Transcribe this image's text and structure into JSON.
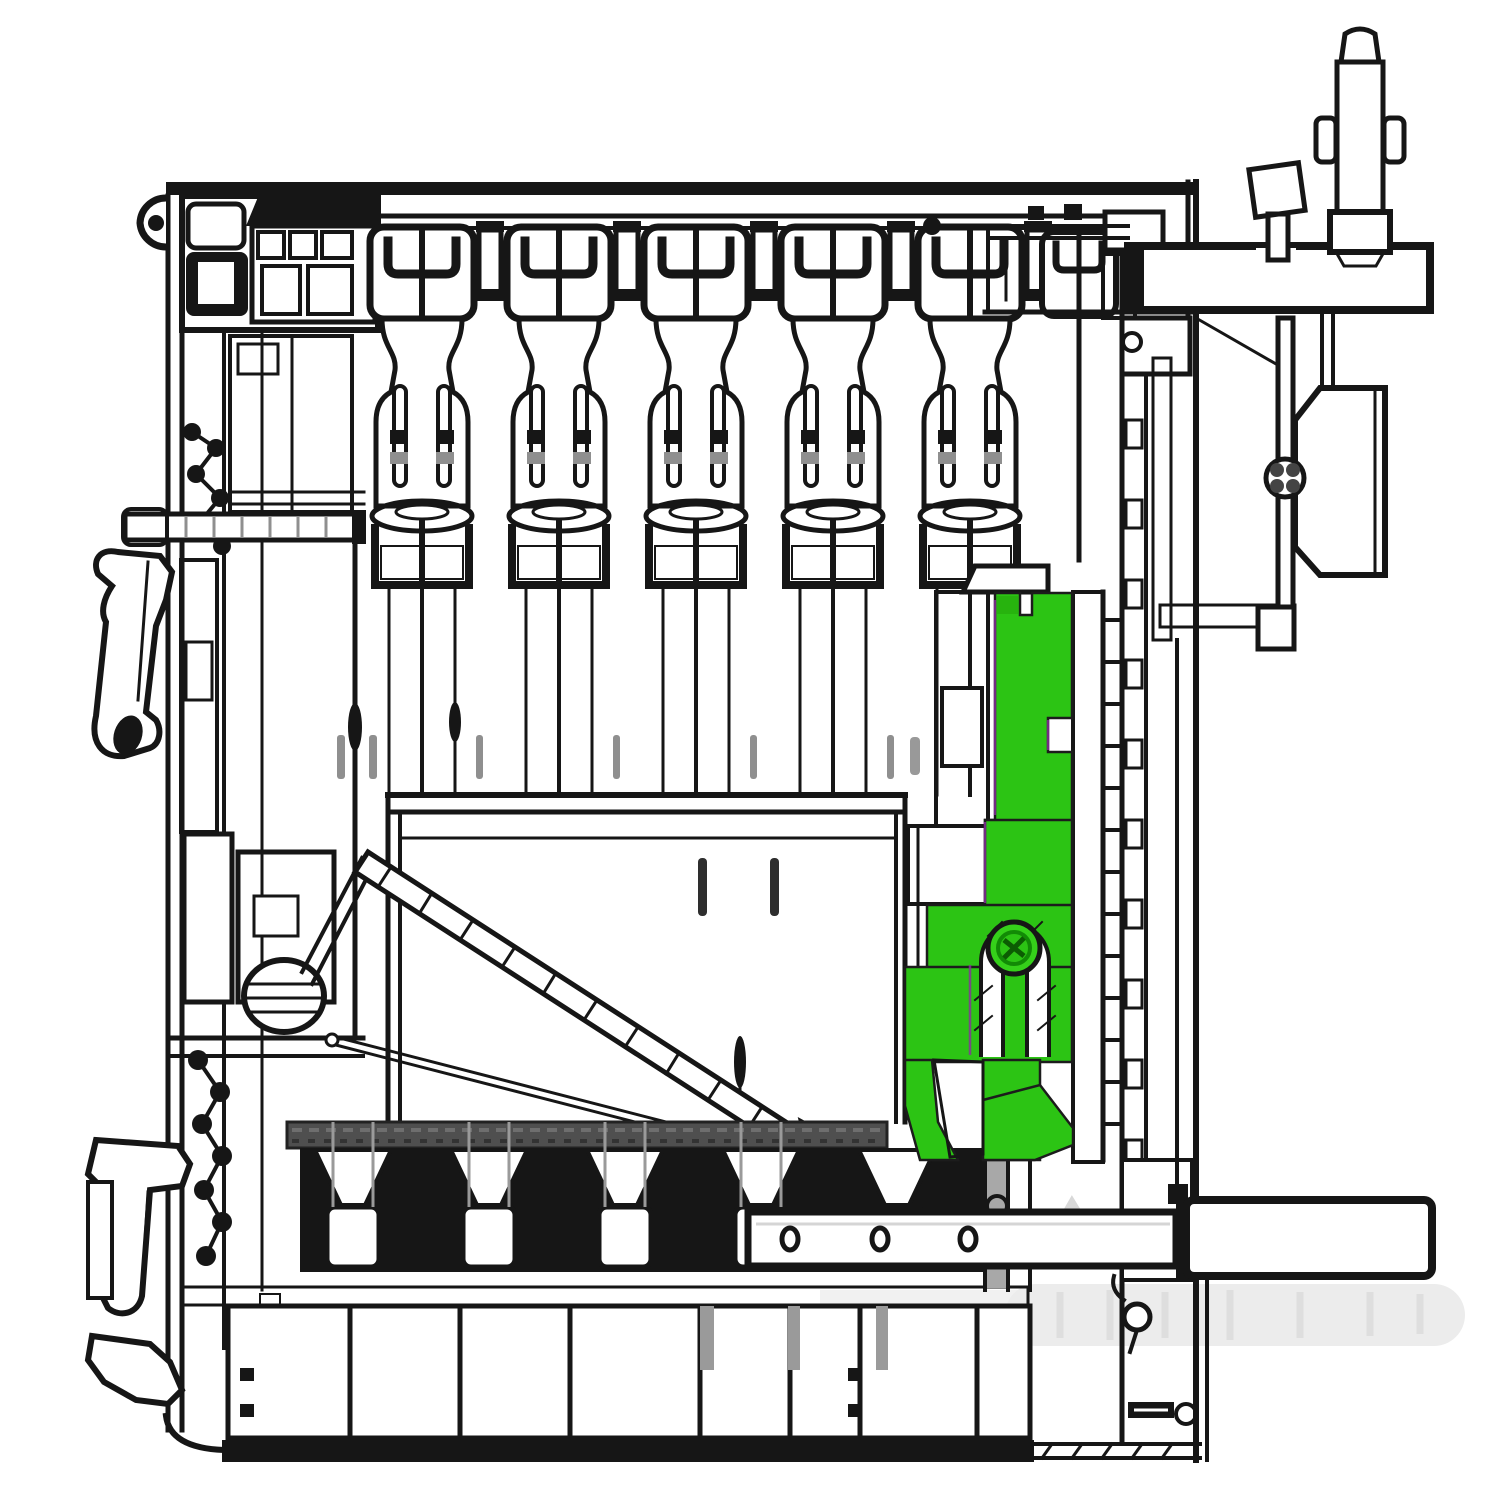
{
  "page": {
    "background": "#ffffff",
    "width": 1500,
    "height": 1500
  },
  "palette": {
    "ink": "#161616",
    "mid_gray": "#8f8f8f",
    "soft_gray": "#c7c7c7",
    "dark_band_gray": "#4f4f4f",
    "ghost_gray": "#ececec",
    "highlight_green": "#2cc414",
    "highlight_green_dark": "#128a06",
    "accent_magenta": "#8a2f9e"
  },
  "diagram": {
    "kind": "black-and-white machine cross-section drawing with one component highlighted in green",
    "highlight": {
      "label": "highlighted bracket with arch slot and pivot screw",
      "color": "#2cc414"
    },
    "counts": {
      "top_plunger_units": 6,
      "bottom_segment_cells": 5,
      "holes_in_bottom_bar": 3,
      "left_side_clamps": 3
    },
    "labels": {
      "frame": "machine frame cross-section",
      "top_rail": "top frame rail",
      "plunger_array": "vertical plunger unit array",
      "left_column": "left-side linkage column",
      "left_clamps": "left mounting clamps",
      "open_room": "open interior chamber",
      "diagonal_lever": "hatched diagonal lever",
      "highlighted_part": "highlighted bracket (green)",
      "pivot_screw": "green pivot screw",
      "hatched_jambs": "hatched guide jambs",
      "right_wall": "right-side frame wall",
      "mounting_bar": "top-right mounting bar",
      "adjusting_screw": "threaded adjusting screw",
      "side_housing": "right-side housing box",
      "comb_bar": "dark comb bar",
      "segment_cells": "segment cell row",
      "key_front_row": "lower key-front row",
      "holes_bar": "bottom bar with three holes",
      "long_bar": "bottom-right long bar",
      "ghost_roller": "faded roller silhouette",
      "bottom_frame": "bottom frame band"
    }
  }
}
